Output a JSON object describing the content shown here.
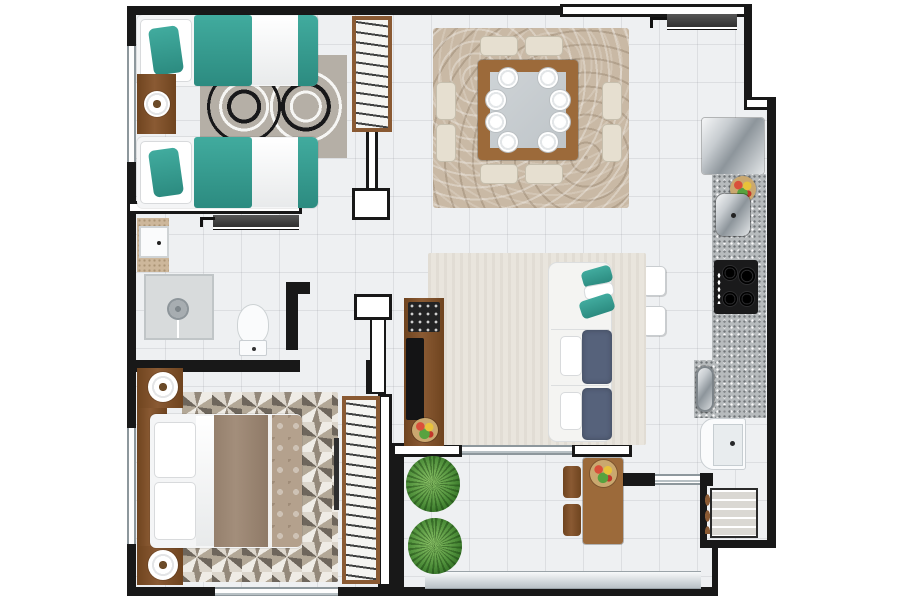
{
  "meta": {
    "type": "apartment-floor-plan",
    "view": "top-down-3d-render",
    "visible_text": "none"
  },
  "palette": {
    "wall": "#181818",
    "floor": "#eef0f2",
    "teal": "#41ab9e",
    "teal_dark": "#2c8b80",
    "wood": "#8a5a33",
    "wood_dark": "#6f441f",
    "wood_mid": "#9c6a3a",
    "rug_dining": "#c9b9a5",
    "rug_living": "#e9e5dd",
    "rug_bed1": "#b5afa6",
    "granite": "#b7bbbd",
    "navy": "#56627b",
    "beige_chair": "#e6dfd0",
    "plant": "#4e8f3a",
    "plant_dark": "#2f6b22",
    "taupe_duvet": "#a38e7b",
    "runner": "#b4a18d"
  },
  "rooms": [
    {
      "id": "bedroom-twin",
      "position": "top-left",
      "furniture": [
        "twin-bed x2 (teal bedding)",
        "nightstand with round lamp",
        "patterned circle rug",
        "wardrobe with hangers",
        "window on left wall"
      ]
    },
    {
      "id": "dining-room",
      "position": "top-center",
      "furniture": [
        "square wood table with glass center",
        "8 beige chairs",
        "8 place settings",
        "swirl tan rug"
      ]
    },
    {
      "id": "entry",
      "position": "top-right",
      "furniture": [
        "sliding entrance door"
      ]
    },
    {
      "id": "kitchen",
      "position": "right-column",
      "furniture": [
        "refrigerator",
        "granite counter",
        "fruit bowl",
        "canister appliance",
        "4-burner cooktop",
        "oval sink",
        "granite bar with 2 white stools"
      ]
    },
    {
      "id": "living-room",
      "position": "center",
      "furniture": [
        "beige area rug",
        "white sofa with navy cushions and teal pillows",
        "wood TV cabinet with flat TV",
        "flower pot"
      ]
    },
    {
      "id": "bathroom",
      "position": "middle-left",
      "furniture": [
        "square basin on counter",
        "shower with round head",
        "toilet",
        "dark sliding pocket door"
      ]
    },
    {
      "id": "bedroom-master",
      "position": "bottom-left",
      "furniture": [
        "double bed taupe duvet",
        "2 nightstands with round lamps",
        "geometric mosaic rug",
        "wardrobe with hangers",
        "windows left and bottom"
      ]
    },
    {
      "id": "balcony",
      "position": "bottom-center",
      "furniture": [
        "2 potted plants",
        "wood bistro table with fruit bowl",
        "2 wood chairs",
        "glass railing"
      ]
    },
    {
      "id": "service-area",
      "position": "bottom-right",
      "furniture": [
        "white laundry tub",
        "shelf cabinet with towels",
        "window to balcony"
      ]
    }
  ],
  "counts": {
    "dining_chairs": 8,
    "dining_plates": 8,
    "bar_stools": 2,
    "plants": 2,
    "beds": 3,
    "wardrobes": 2
  }
}
